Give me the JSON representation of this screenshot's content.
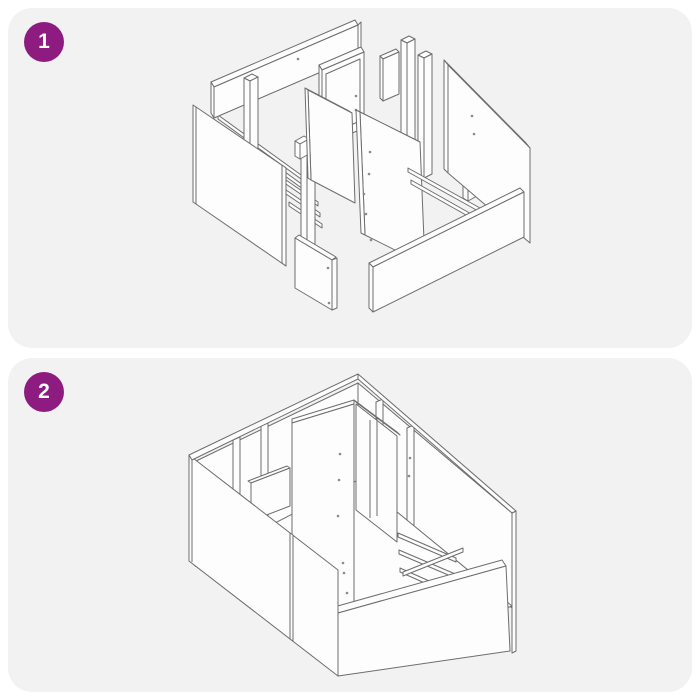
{
  "colors": {
    "accent": "#8E1C80",
    "page-bg": "#ffffff",
    "panel-bg": "#F2F2F3",
    "line": "#6D6D6D",
    "part-fill": "#FDFDFE",
    "dot": "#8a8a8a",
    "badge-text": "#ffffff"
  },
  "steps": [
    {
      "number": "1",
      "illustration": "exploded-parts-isometric-view"
    },
    {
      "number": "2",
      "illustration": "assembled-frame-isometric-view"
    }
  ]
}
